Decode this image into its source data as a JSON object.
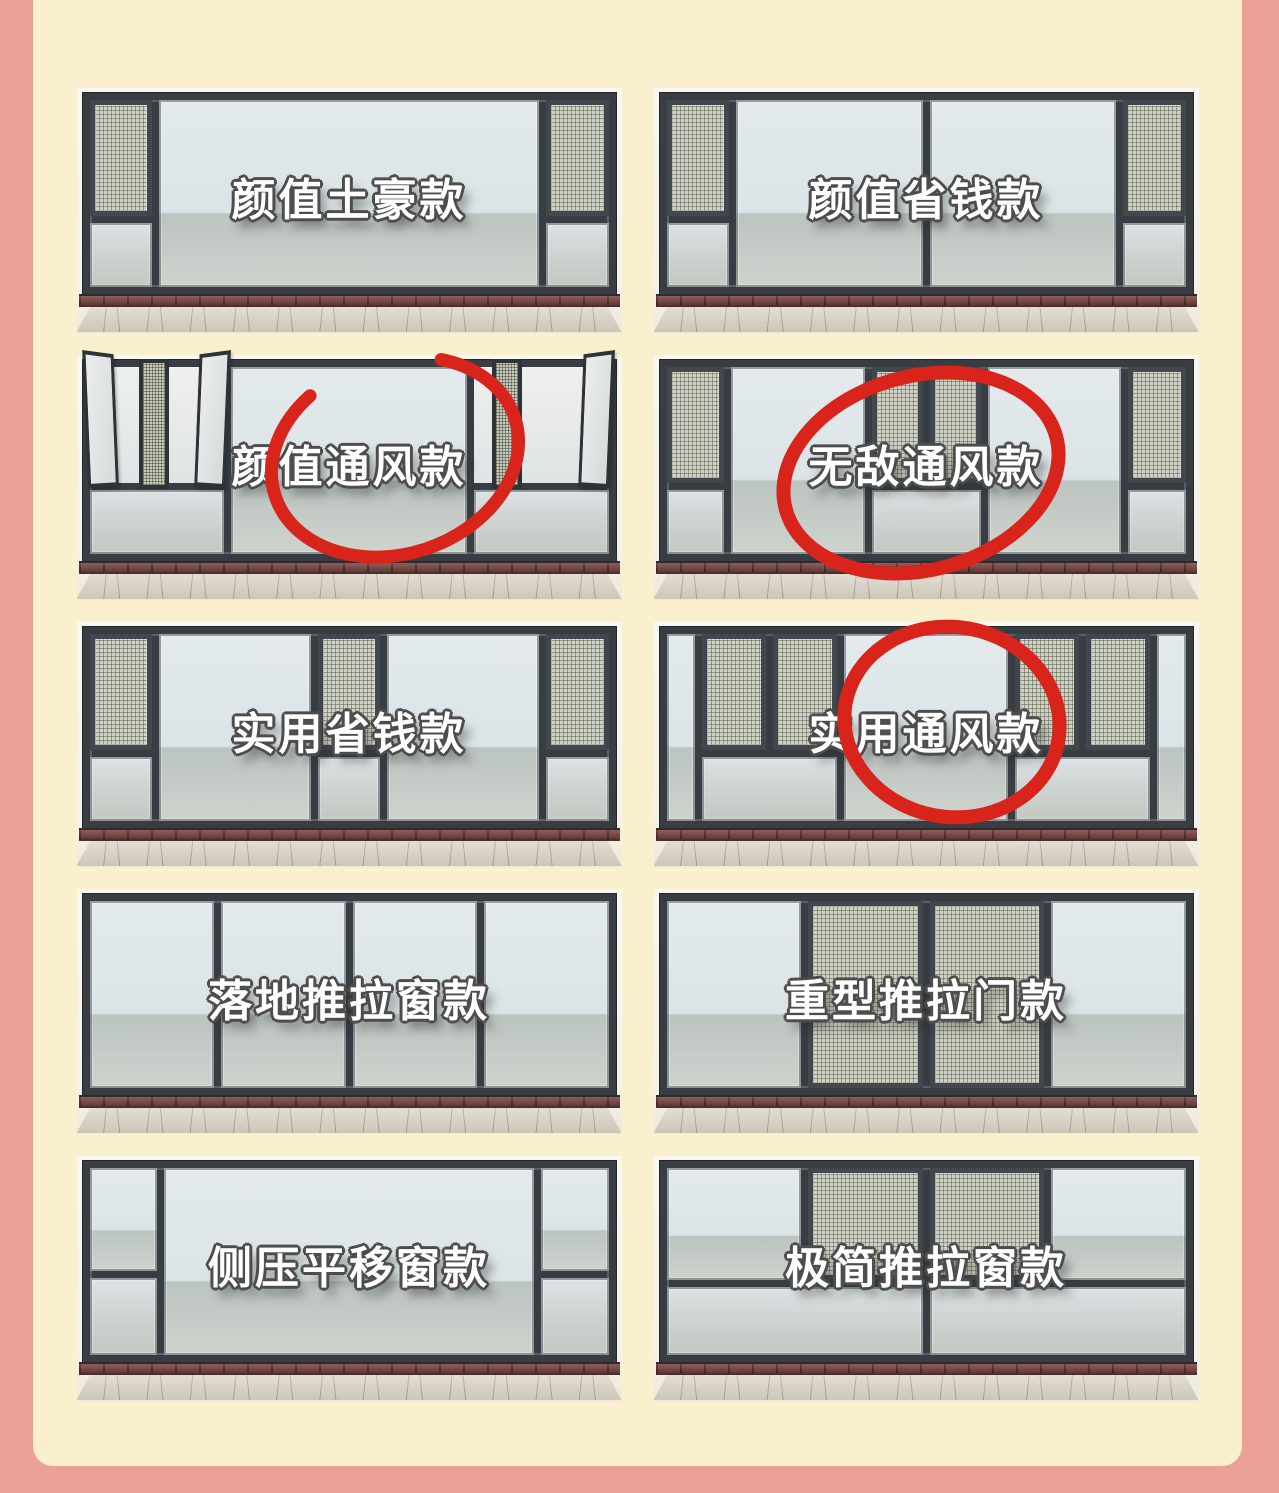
{
  "page": {
    "type": "window-style-comparison-infographic",
    "background_color": "#EBA198",
    "board_color": "#FBF0CD"
  },
  "colors": {
    "window_frame": "#383D43",
    "glass": "#E0E7EA",
    "mesh_screen": "#CFD2C4",
    "brick_sill": "#7A4541",
    "floor": "#D9D3C3",
    "annotation_red": "#D8241B",
    "label_fill": "#FFFFFF",
    "label_outline": "#4D4D4D"
  },
  "annotation": {
    "shape": "hand-drawn-red-circle",
    "circled_labels": [
      "颜值通风款",
      "无敌通风款",
      "实用通风款"
    ]
  },
  "panels": [
    {
      "label": "颜值土豪款",
      "circled": false
    },
    {
      "label": "颜值省钱款",
      "circled": false
    },
    {
      "label": "颜值通风款",
      "circled": true
    },
    {
      "label": "无敌通风款",
      "circled": true
    },
    {
      "label": "实用省钱款",
      "circled": false
    },
    {
      "label": "实用通风款",
      "circled": true
    },
    {
      "label": "落地推拉窗款",
      "circled": false
    },
    {
      "label": "重型推拉门款",
      "circled": false
    },
    {
      "label": "侧压平移窗款",
      "circled": false
    },
    {
      "label": "极简推拉窗款",
      "circled": false
    }
  ]
}
